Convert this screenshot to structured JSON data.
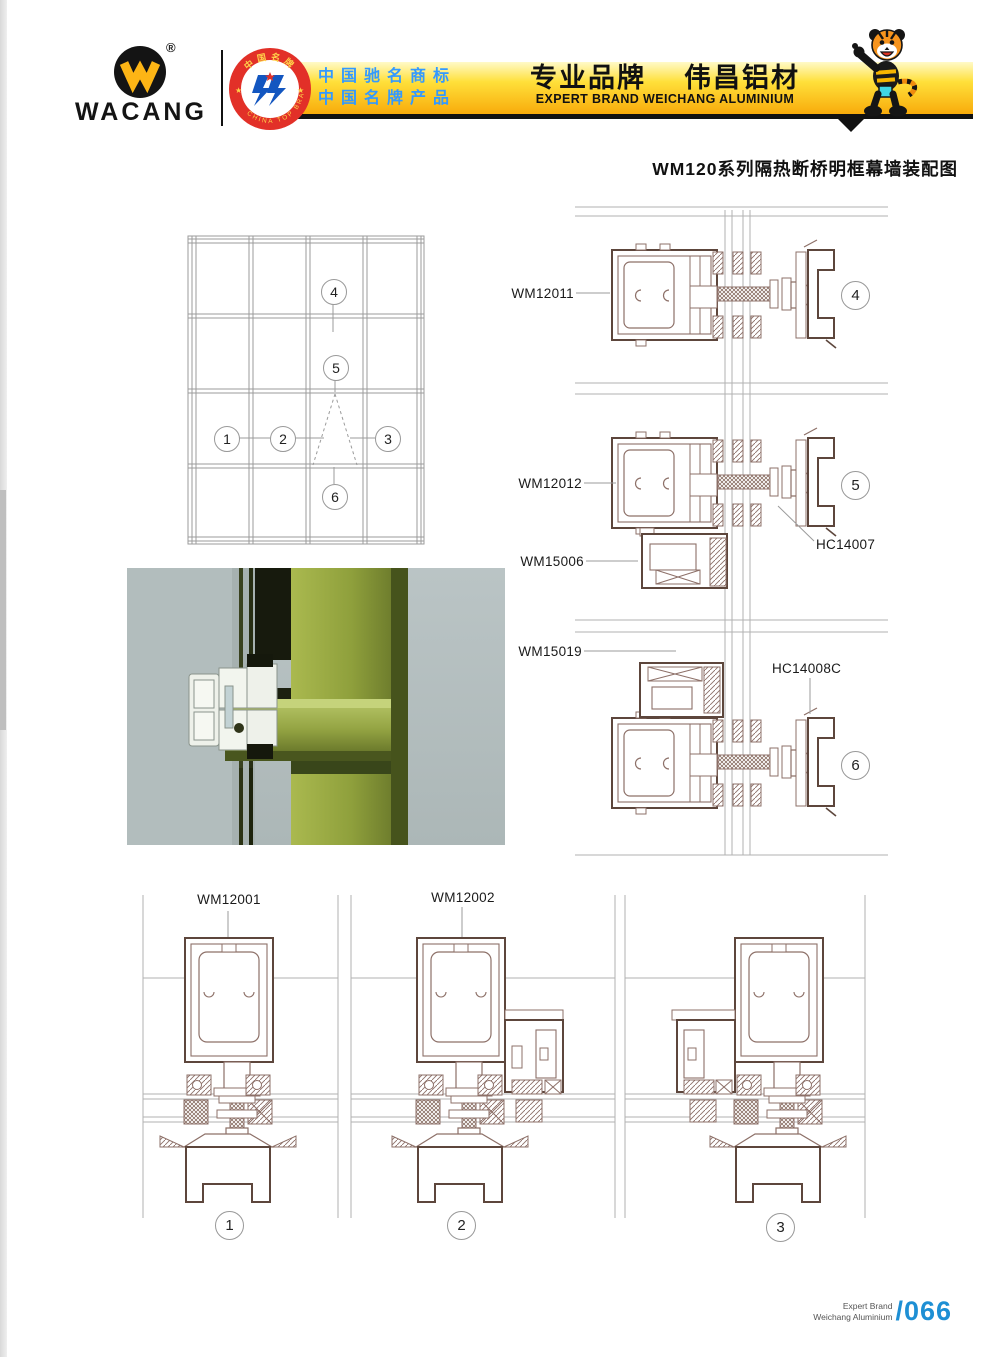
{
  "header": {
    "logo": {
      "brand": "WACANG",
      "registered": "®"
    },
    "badge": {
      "top_text": "中国名牌",
      "bottom_text": "CHINA TOP BRAND"
    },
    "banner": {
      "line1": "中国驰名商标",
      "line2": "中国名牌产品",
      "title_left": "专业品牌",
      "title_right": "伟昌铝材",
      "subtitle": "EXPERT BRAND WEICHANG ALUMINIUM",
      "colors": {
        "banner_yellow": "#f8ab0b",
        "text_blue": "#3399ff"
      }
    }
  },
  "page_title": "WM120系列隔热断桥明框幕墙装配图",
  "labels": {
    "wm12011": "WM12011",
    "wm12012": "WM12012",
    "hc14007": "HC14007",
    "wm15006": "WM15006",
    "wm15019": "WM15019",
    "hc14008c": "HC14008C",
    "wm12001": "WM12001",
    "wm12002": "WM12002"
  },
  "callouts": {
    "c1": "1",
    "c2": "2",
    "c3": "3",
    "c4": "4",
    "c5": "5",
    "c6": "6"
  },
  "footer": {
    "line1": "Expert Brand",
    "line2": "Weichang Aluminium",
    "page": "/066",
    "accent_blue": "#1e8fd4"
  },
  "colors": {
    "profile_stroke": "#8d7068",
    "profile_dark": "#5d463c",
    "photo_green": "#8fa03c"
  }
}
